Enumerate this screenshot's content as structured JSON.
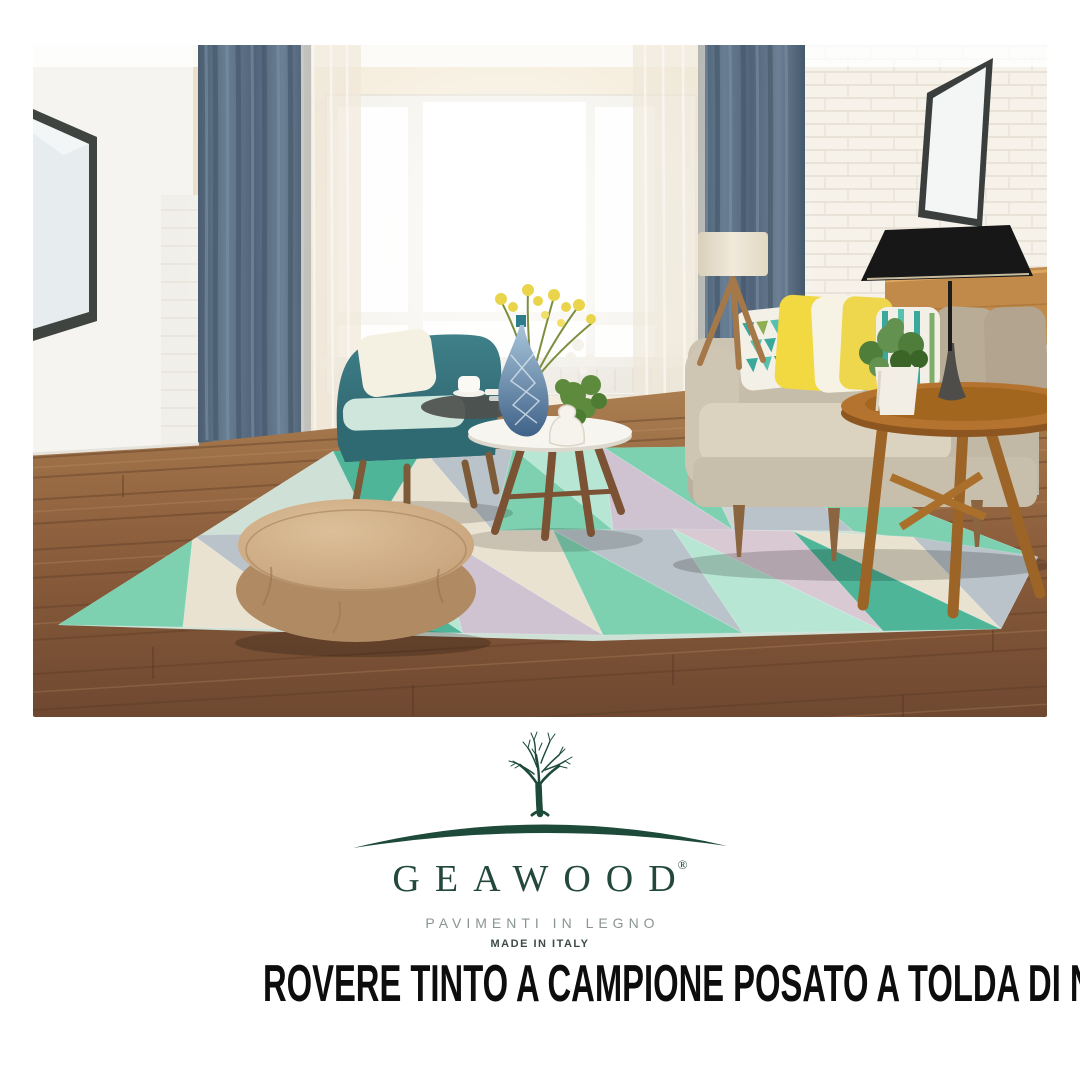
{
  "poster": {
    "background": "#ffffff"
  },
  "photo": {
    "description": "Scandinavian living room: wood plank floor, pastel geometric rug, round tan pouf, teal armchair, beige sofa with yellow and teal pillows, blue-gray curtains, large bright window, black table lamp on round wooden side table, leaning wall mirrors",
    "palette": {
      "floor_wood": "#8a5c3a",
      "rug_mint": "#7ed1b0",
      "rug_teal": "#4eb598",
      "rug_gray": "#b9c3c9",
      "rug_lavender": "#cfc3d2",
      "rug_cream": "#eae2d0",
      "curtain_blue": "#566b80",
      "sofa_beige": "#c6bcab",
      "armchair_teal": "#36757d",
      "pouf_tan": "#c9a67f",
      "pillow_yellow": "#f2d841",
      "wall_cream": "#ecdfc8",
      "wall_white": "#f5f4f1",
      "lamp_black": "#171717",
      "side_table_wood": "#b4732e"
    }
  },
  "logo": {
    "brand": "GEAWOOD",
    "registered_mark": "®",
    "tagline": "PAVIMENTI IN LEGNO",
    "origin": "MADE IN ITALY",
    "brand_color": "#24493c",
    "tagline_color": "#8a9593",
    "origin_color": "#3e4b48",
    "icon": "tree-over-hill-icon"
  },
  "headline": {
    "text": "ROVERE TINTO A CAMPIONE POSATO A TOLDA DI NAVE",
    "color": "#0d0d0d"
  }
}
